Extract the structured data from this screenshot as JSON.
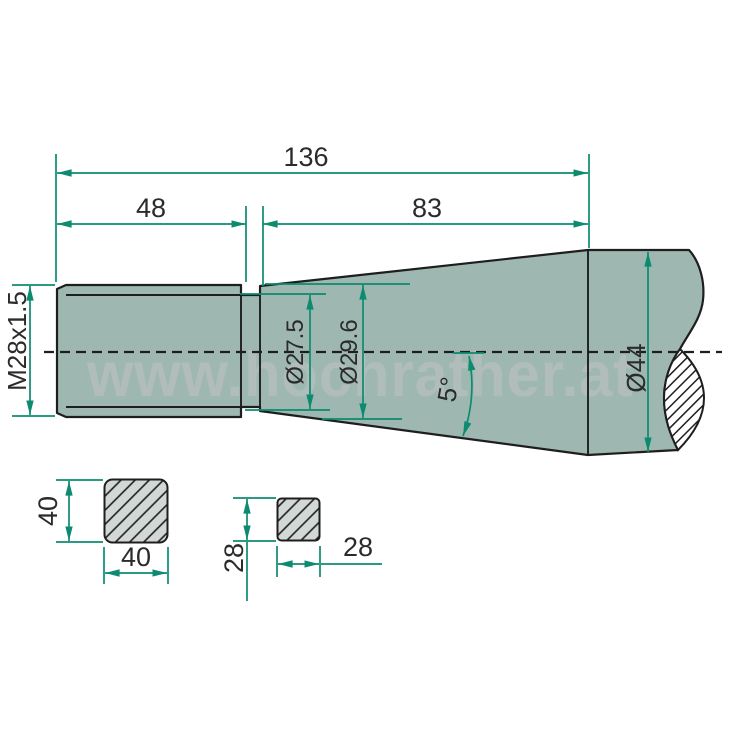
{
  "colors": {
    "part_fill": "#9eb8b1",
    "outline": "#1e1e1e",
    "dimension": "#0c8b70",
    "dim_text": "#2b2b2b",
    "section_fill": "#d2d8d6",
    "watermark": "#bcc1c0",
    "background": "#ffffff"
  },
  "watermark": {
    "text": "www.hochrather.at"
  },
  "side_view": {
    "labels": {
      "overall_length": "136",
      "thread_length": "48",
      "taper_length": "83",
      "thread_spec": "M28x1.5",
      "taper_small_dia": "Ø27.5",
      "taper_mid_dia": "Ø29.6",
      "taper_angle": "5°",
      "shaft_dia": "Ø44"
    }
  },
  "cross_sections": {
    "large_square": {
      "height": "40",
      "width": "40"
    },
    "small_square": {
      "height": "28",
      "width": "28"
    }
  }
}
